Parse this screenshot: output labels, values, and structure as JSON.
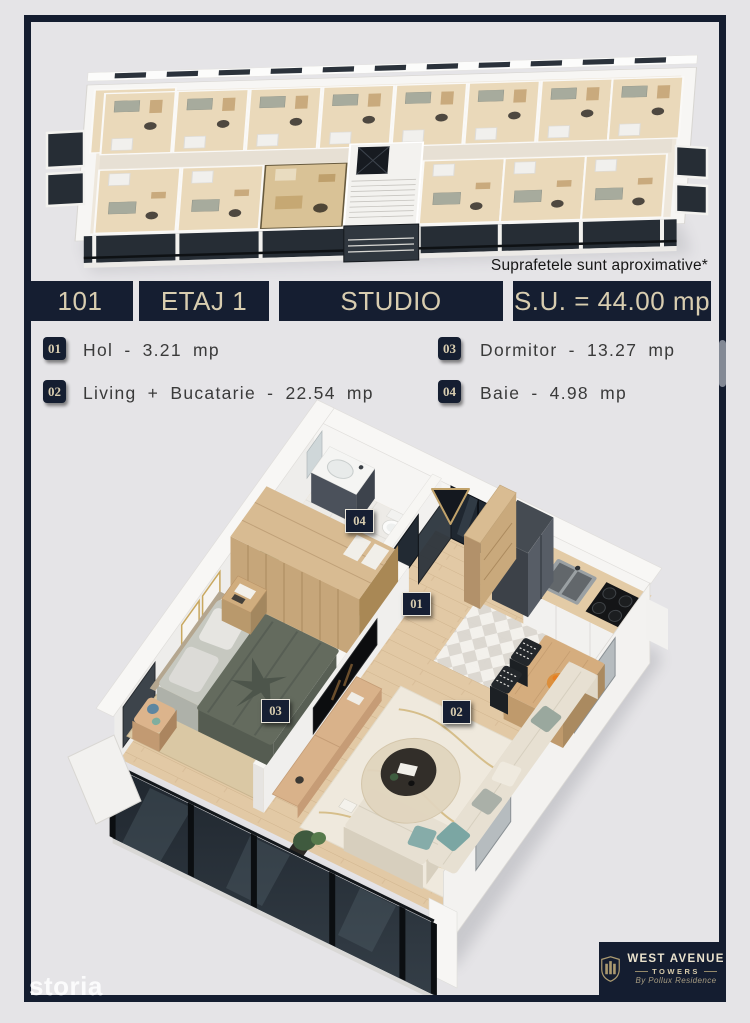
{
  "page": {
    "background": "#e5e4e7",
    "frame_color": "#141d30"
  },
  "colors": {
    "navy": "#151e31",
    "cream": "#d8cdb0",
    "highlight_unit": "#d9c296",
    "glass": "#242b33",
    "wood_floor": "#e2c9a5"
  },
  "disclaimer": "Suprafetele sunt aproximative*",
  "info_badges": [
    {
      "id": "unit-number",
      "text": "101"
    },
    {
      "id": "floor",
      "text": "ETAJ 1"
    },
    {
      "id": "unit-type",
      "text": "STUDIO"
    },
    {
      "id": "usable-area",
      "text": "S.U. = 44.00 mp"
    }
  ],
  "legend": {
    "left": [
      {
        "num": "01",
        "text": "Hol - 3.21 mp"
      },
      {
        "num": "02",
        "text": "Living + Bucatarie - 22.54 mp"
      }
    ],
    "right": [
      {
        "num": "03",
        "text": "Dormitor - 13.27 mp"
      },
      {
        "num": "04",
        "text": "Baie - 4.98 mp"
      }
    ]
  },
  "plan_markers": [
    {
      "num": "01"
    },
    {
      "num": "02"
    },
    {
      "num": "03"
    },
    {
      "num": "04"
    }
  ],
  "logo": {
    "name": "WEST AVENUE",
    "sub": "TOWERS",
    "tagline": "By Pollux Residence"
  },
  "watermark": "storia"
}
